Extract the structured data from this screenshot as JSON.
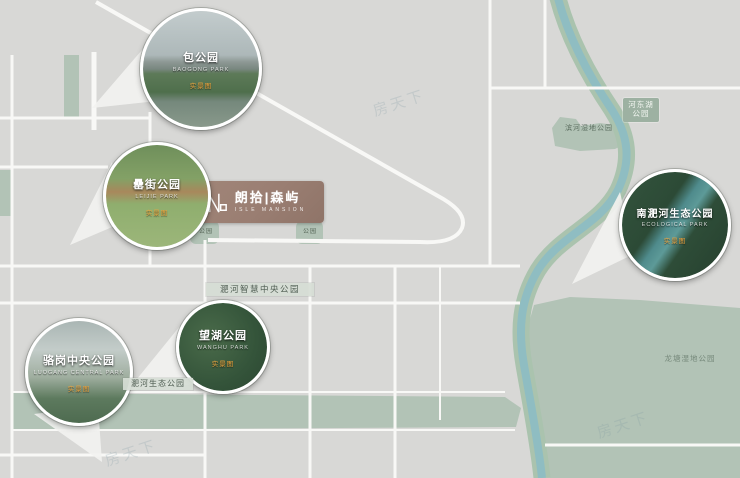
{
  "project": {
    "name_cn": "朗拾|森屿",
    "name_en": "ISLE MANSION"
  },
  "park_callouts": [
    {
      "name": "包公园",
      "name_en": "BAOGONG PARK",
      "tag": "实景图"
    },
    {
      "name": "罍街公园",
      "name_en": "LEIJIE PARK",
      "tag": "实景图"
    },
    {
      "name": "南淝河生态公园",
      "name_en": "ECOLOGICAL PARK",
      "tag": "实景图"
    },
    {
      "name": "望湖公园",
      "name_en": "WANGHU PARK",
      "tag": "实景图"
    },
    {
      "name": "骆岗中央公园",
      "name_en": "LUOGANG CENTRAL PARK",
      "tag": "实景图"
    }
  ],
  "map_labels": {
    "zhihui": "淝河智慧中央公园",
    "shengtai": "淝河生态公园",
    "hedong_line1": "河东湖",
    "hedong_line2": "公园",
    "wetland": "滨河湿地公园",
    "longtang": "龙塘湿地公园",
    "blob_a": "公园",
    "blob_b": "公园"
  },
  "watermark": "房天下",
  "colors": {
    "background": "#d8d8d6",
    "park_green": "#b2c3b6",
    "river": "#8fbdc2",
    "river_bank": "#aac3ae",
    "road": "#f8f8f6",
    "logo_plate": "#9d8177",
    "tag_orange": "#f0a43c"
  }
}
